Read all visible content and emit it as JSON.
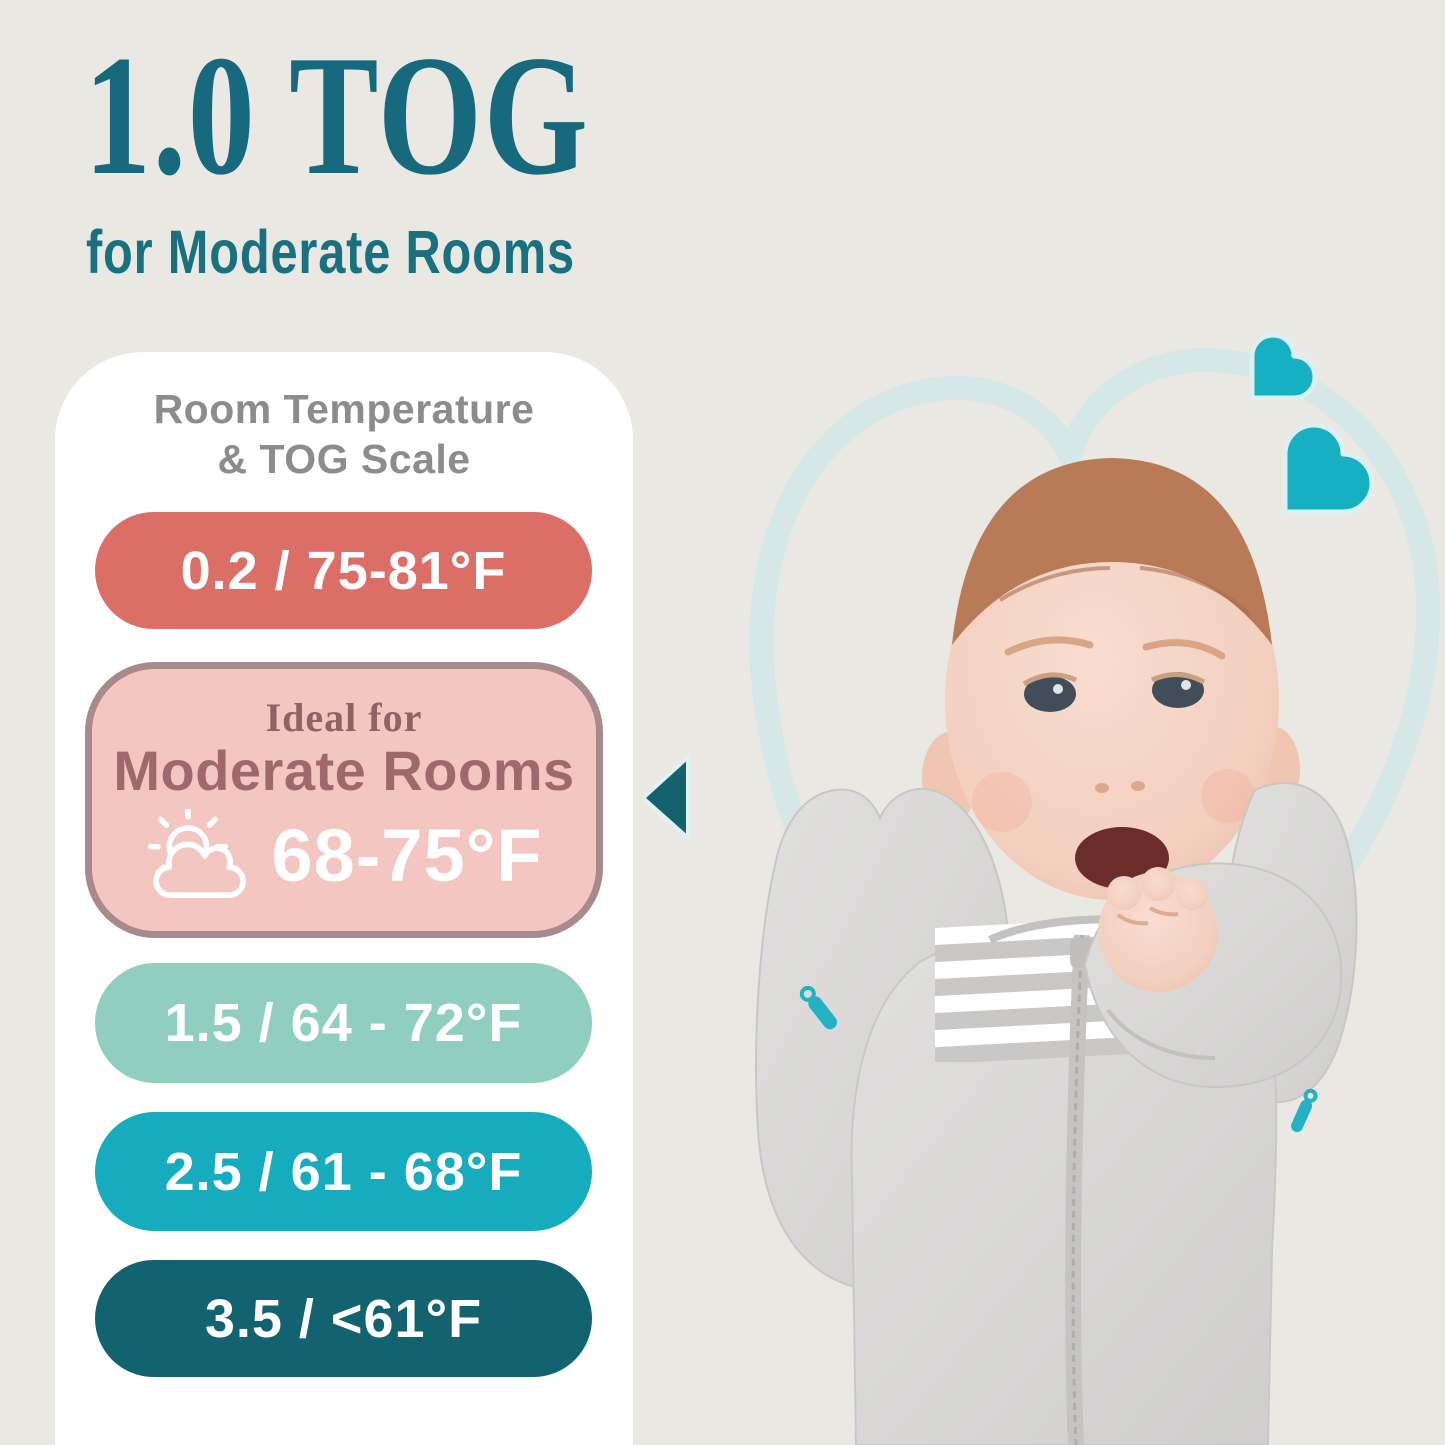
{
  "page": {
    "background_color": "#eae8e3"
  },
  "heading": {
    "title": "1.0 TOG",
    "subtitle": "for Moderate Rooms",
    "text_color": "#17697e"
  },
  "tog_card": {
    "title_line1": "Room Temperature",
    "title_line2": "& TOG Scale",
    "title_color": "#8c8c8c",
    "background_color": "#ffffff",
    "pointer_color": "#15626f",
    "scale": [
      {
        "tog": "0.2",
        "temp_range": "75-81°F",
        "label": "0.2 / 75-81°F",
        "color": "#dc6e68",
        "highlighted": false
      },
      {
        "tog": "1.0",
        "temp_range": "68-75°F",
        "ideal_text": "Ideal for",
        "room_text": "Moderate Rooms",
        "temp_text": "68-75°F",
        "color": "#f4c6c2",
        "border_color": "#a98a8c",
        "icon": "sun-behind-cloud-icon",
        "highlighted": true
      },
      {
        "tog": "1.5",
        "temp_range": "64 - 72°F",
        "label": "1.5 / 64 - 72°F",
        "color": "#90cfc0",
        "highlighted": false
      },
      {
        "tog": "2.5",
        "temp_range": "61 - 68°F",
        "label": "2.5 / 61 - 68°F",
        "color": "#17abbe",
        "highlighted": false
      },
      {
        "tog": "3.5",
        "temp_range": "<61°F",
        "label": "3.5 / <61°F",
        "color": "#12636f",
        "highlighted": false
      }
    ]
  },
  "decor": {
    "heart_solid_color": "#17b0c3",
    "heart_outline_color": "#d6e7e8"
  }
}
